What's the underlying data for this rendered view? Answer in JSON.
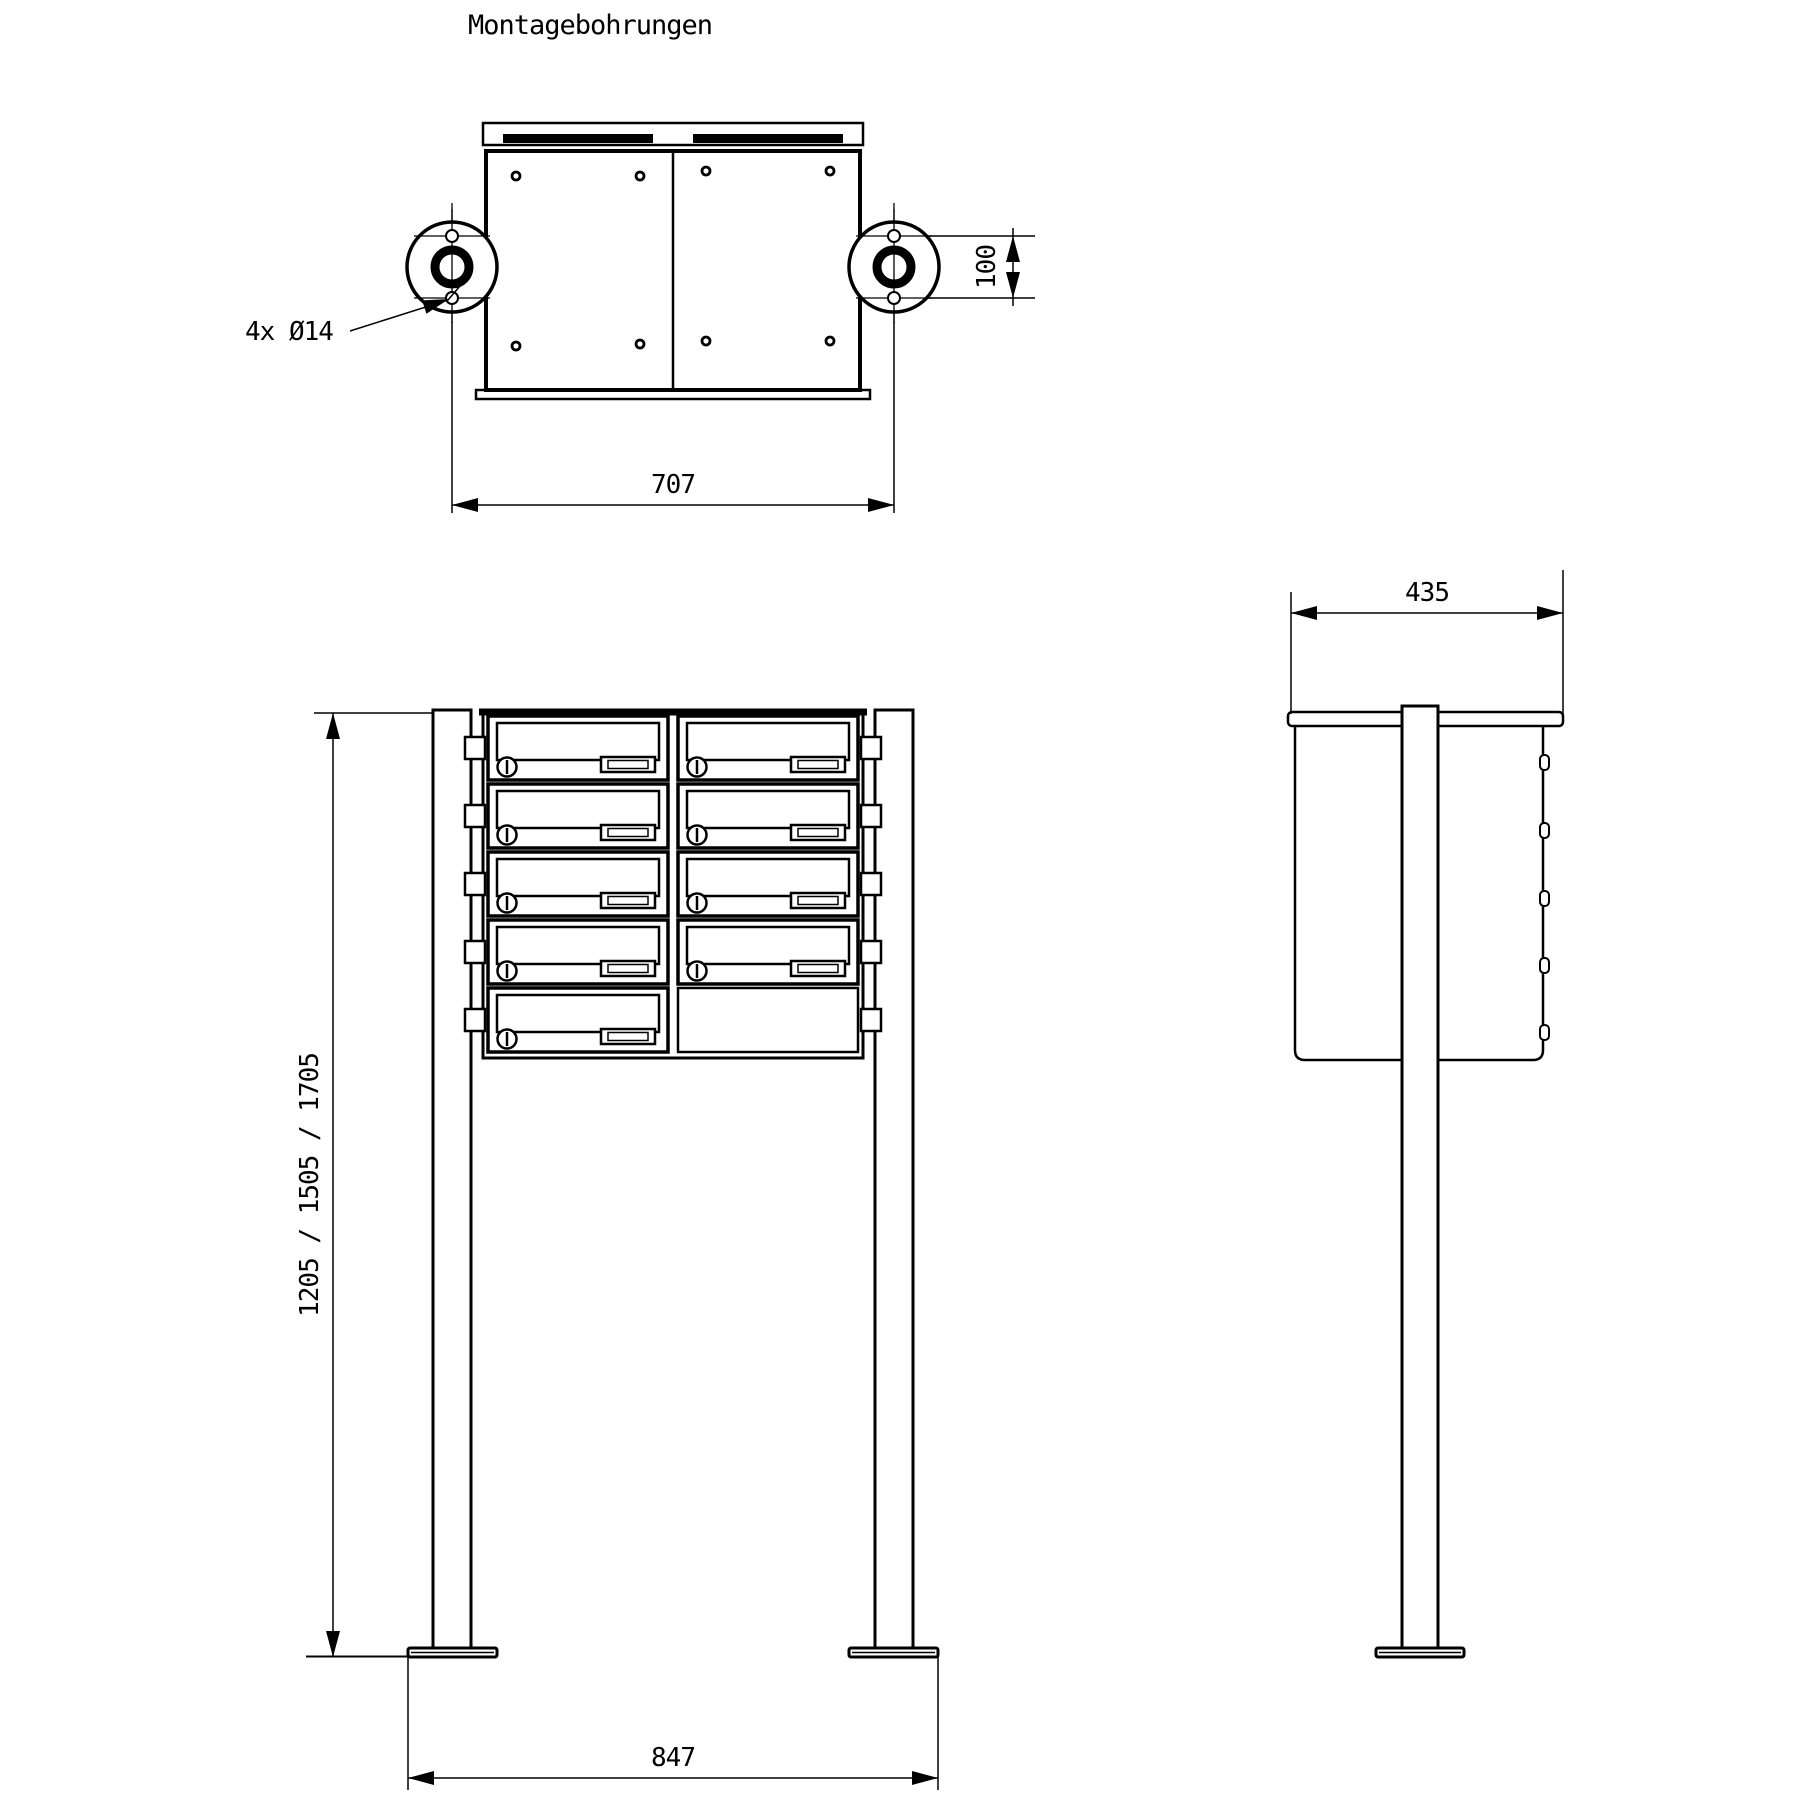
{
  "title": "Montagebohrungen",
  "colors": {
    "line": "#000000",
    "background": "#ffffff"
  },
  "top_view": {
    "hole_callout": "4x Ø14",
    "dim_width": "707",
    "dim_hole_spacing": "100"
  },
  "front_view": {
    "dim_heights": "1205 / 1505 / 1705",
    "dim_base_width": "847",
    "mailbox_rows": 5,
    "mailbox_columns": 2,
    "mailbox_count": 9
  },
  "side_view": {
    "dim_depth": "435"
  }
}
